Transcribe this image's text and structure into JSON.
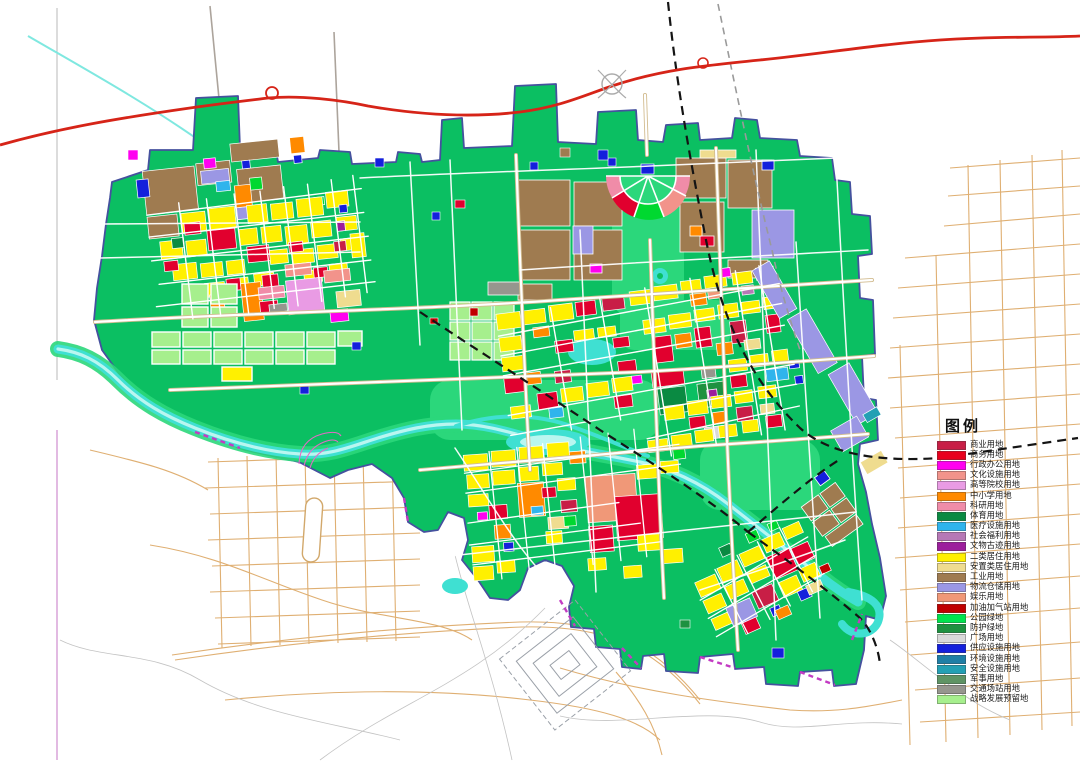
{
  "legend": {
    "title": "图例",
    "items": [
      {
        "label": "商业用地",
        "color": "#C81E46"
      },
      {
        "label": "商务用地",
        "color": "#E8001E"
      },
      {
        "label": "行政办公用地",
        "color": "#FF00F0"
      },
      {
        "label": "文化设施用地",
        "color": "#F2938B"
      },
      {
        "label": "高等院校用地",
        "color": "#E99BE4"
      },
      {
        "label": "中小学用地",
        "color": "#FF8A00"
      },
      {
        "label": "科研用地",
        "color": "#F08CA8"
      },
      {
        "label": "体育用地",
        "color": "#0A8A42"
      },
      {
        "label": "医疗设施用地",
        "color": "#2FB4EC"
      },
      {
        "label": "社会福利用地",
        "color": "#B678B6"
      },
      {
        "label": "文物古迹用地",
        "color": "#9C1E9C"
      },
      {
        "label": "二类居住用地",
        "color": "#FFF000"
      },
      {
        "label": "安置类居住用地",
        "color": "#EFDC8F"
      },
      {
        "label": "工业用地",
        "color": "#9F7B50"
      },
      {
        "label": "物流仓储用地",
        "color": "#9B97E4"
      },
      {
        "label": "娱乐用地",
        "color": "#F09878"
      },
      {
        "label": "加油加气站用地",
        "color": "#C00000"
      },
      {
        "label": "公园绿地",
        "color": "#00E34E"
      },
      {
        "label": "防护绿地",
        "color": "#1E9140"
      },
      {
        "label": "广场用地",
        "color": "#D9D9D9"
      },
      {
        "label": "供应设施用地",
        "color": "#1420DC"
      },
      {
        "label": "环境设施用地",
        "color": "#1F7FA6"
      },
      {
        "label": "安全设施用地",
        "color": "#23A0B4"
      },
      {
        "label": "军事用地",
        "color": "#5F9464"
      },
      {
        "label": "交通场站用地",
        "color": "#96968E"
      },
      {
        "label": "战略发展预留地",
        "color": "#A6EF8D"
      }
    ]
  },
  "map_colors": {
    "urban_green": "#0BBF62",
    "park_green": "#2BD77B",
    "reserve_green": "#A6EF8D",
    "river_cyan": "#3FE0D2",
    "river_light": "#B9F6F0",
    "expressway_red": "#D62418",
    "railway_black": "#141414",
    "rural_road_tan": "#DFAF72",
    "boundary_slate": "#45519E",
    "boundary_purple": "#C33BC3"
  }
}
